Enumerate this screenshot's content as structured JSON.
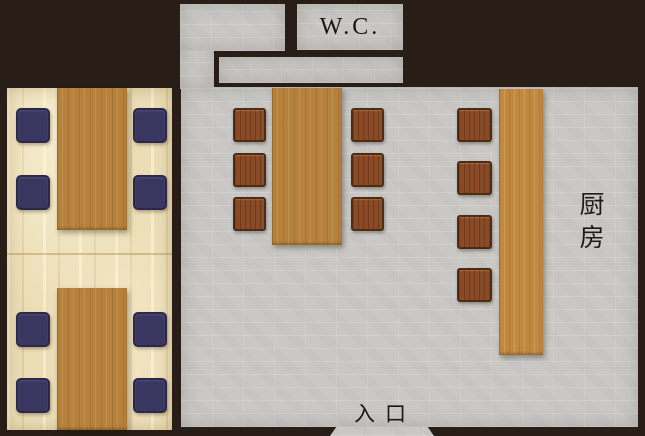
{
  "labels": {
    "wc": "W.C.",
    "kitchen": "厨房",
    "entrance": "入口"
  },
  "colors": {
    "background_wall": "#281e17",
    "floor_stone": "#c9c8c5",
    "tatami": "#ebddb5",
    "table_wood": "#b5813c",
    "counter_wood": "#c18840",
    "chair_wood": "#8a4a25",
    "cushion_navy": "#393660",
    "label_text": "#161616"
  },
  "rooms": {
    "tatami_room": {
      "tables": 2,
      "cushions_per_table": 4
    },
    "dining_floor": {
      "table_chairs": 6,
      "counter_stools": 4
    },
    "kitchen": {
      "label": "厨房"
    },
    "toilet": {
      "label": "W.C."
    }
  }
}
